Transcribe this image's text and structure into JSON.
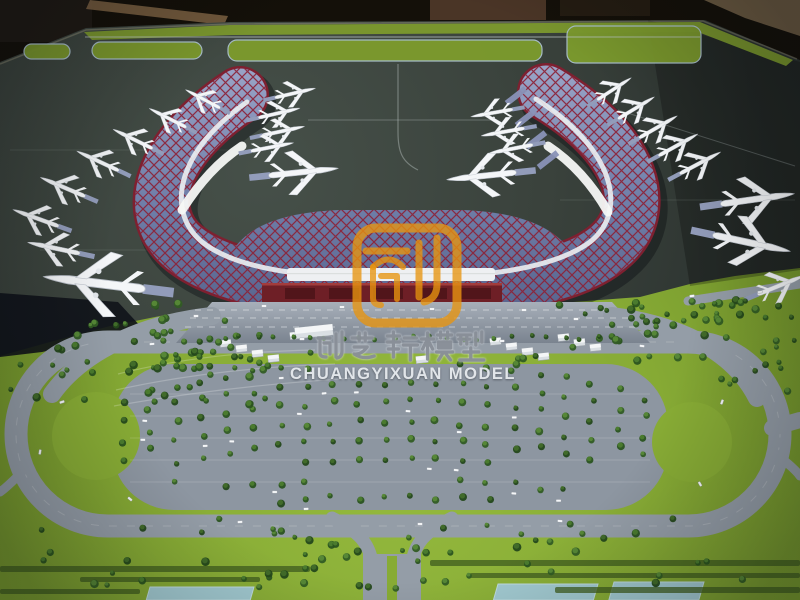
{
  "photo": {
    "subject": "Architectural scale model of an airport: U-shaped blue terminal with red lattice roof, white model aircraft at gates, tree-lined oval parking loop, displayed in a workshop",
    "watermark": {
      "logo_char": "创",
      "text_cn": "创艺轩模型",
      "text_en": "CHUANGYIXUAN MODEL",
      "logo_color": "#E8950F",
      "text_color": "#D8DCE2"
    }
  },
  "scene": {
    "colors": {
      "apron": "#3A423C",
      "grass": "#87AB35",
      "grassLight": "#95BA3E",
      "grassDark": "#74962C",
      "islandGreen": "#7C9A2D",
      "road": "#949DA7",
      "parking": "#8D96A1",
      "roofLight": "#98A3C6",
      "roofMid": "#7180AA",
      "roofDark": "#57628C",
      "lattice": "#8C2137",
      "rim": "#7E2030",
      "terminalFront": "#6E1F26",
      "canopy": "#EEF0F2",
      "water": "#A3CBD9",
      "workshop": "#141009",
      "plane": "#F4F6F8",
      "logoOrange": "#E8950F",
      "wmGray": "#8A9099"
    },
    "planes": [
      [
        203,
        99,
        -152,
        0.85
      ],
      [
        168,
        118,
        -153,
        0.9
      ],
      [
        133,
        139,
        -154,
        0.95
      ],
      [
        98,
        161,
        -155,
        1.0
      ],
      [
        63,
        187,
        -157,
        1.05
      ],
      [
        36,
        218,
        -160,
        1.05
      ],
      [
        54,
        248,
        -168,
        1.15
      ],
      [
        95,
        283,
        187,
        2.2
      ],
      [
        295,
        93,
        -13,
        0.9
      ],
      [
        279,
        113,
        -13,
        0.92
      ],
      [
        283,
        131,
        -12,
        0.94
      ],
      [
        272,
        147,
        -11,
        0.94
      ],
      [
        303,
        172,
        -6,
        1.5
      ],
      [
        492,
        113,
        170,
        0.92
      ],
      [
        503,
        132,
        170,
        0.95
      ],
      [
        511,
        149,
        169,
        0.97
      ],
      [
        482,
        176,
        174,
        1.5
      ],
      [
        614,
        89,
        -33,
        0.88
      ],
      [
        636,
        108,
        -31,
        0.92
      ],
      [
        658,
        127,
        -30,
        0.95
      ],
      [
        678,
        145,
        -29,
        0.97
      ],
      [
        700,
        163,
        -28,
        1.0
      ],
      [
        757,
        199,
        -8,
        1.6
      ],
      [
        751,
        243,
        12,
        1.7
      ],
      [
        781,
        285,
        -22,
        1.1
      ]
    ],
    "bridges_right": [
      [
        516,
        96
      ],
      [
        526,
        118
      ],
      [
        536,
        140
      ],
      [
        548,
        160
      ]
    ],
    "islands": [
      [
        24,
        44,
        46,
        15
      ],
      [
        92,
        42,
        110,
        17
      ],
      [
        228,
        40,
        314,
        21
      ],
      [
        567,
        26,
        134,
        37
      ]
    ],
    "sheds": [
      [
        220,
        340,
        11,
        7
      ],
      [
        236,
        345,
        11,
        7
      ],
      [
        252,
        350,
        11,
        7
      ],
      [
        268,
        355,
        11,
        7
      ],
      [
        290,
        332,
        12,
        7
      ],
      [
        295,
        326,
        38,
        11
      ],
      [
        416,
        356,
        12,
        7
      ],
      [
        490,
        338,
        11,
        7
      ],
      [
        506,
        343,
        11,
        7
      ],
      [
        522,
        348,
        11,
        7
      ],
      [
        538,
        353,
        11,
        7
      ],
      [
        558,
        334,
        11,
        7
      ],
      [
        574,
        339,
        11,
        7
      ],
      [
        590,
        344,
        11,
        7
      ]
    ],
    "pools": [
      [
        150,
        587,
        104,
        13
      ],
      [
        498,
        584,
        100,
        16
      ],
      [
        614,
        582,
        90,
        18
      ]
    ],
    "hedges": [
      [
        0,
        566,
        310,
        6
      ],
      [
        80,
        577,
        180,
        5
      ],
      [
        430,
        560,
        370,
        6
      ],
      [
        470,
        573,
        330,
        5
      ],
      [
        555,
        587,
        245,
        6
      ],
      [
        0,
        589,
        140,
        5
      ]
    ],
    "cars": [
      [
        62,
        402,
        -18
      ],
      [
        40,
        452,
        -80
      ],
      [
        152,
        344,
        -5
      ],
      [
        302,
        339,
        0
      ],
      [
        502,
        341,
        0
      ],
      [
        642,
        346,
        8
      ],
      [
        722,
        402,
        -70
      ],
      [
        700,
        484,
        60
      ],
      [
        560,
        521,
        5
      ],
      [
        420,
        524,
        0
      ],
      [
        240,
        522,
        -4
      ],
      [
        130,
        499,
        40
      ],
      [
        342,
        307,
        0
      ],
      [
        432,
        309,
        0
      ],
      [
        264,
        306,
        0
      ],
      [
        524,
        310,
        0
      ],
      [
        196,
        316,
        0
      ],
      [
        576,
        319,
        0
      ],
      [
        692,
        296,
        -8
      ],
      [
        760,
        292,
        -8
      ]
    ],
    "tree_clusters": [
      [
        60,
        323,
        200,
        55,
        26
      ],
      [
        140,
        368,
        130,
        40,
        12
      ],
      [
        8,
        345,
        85,
        55,
        9
      ],
      [
        556,
        296,
        188,
        70,
        26
      ],
      [
        688,
        296,
        108,
        26,
        14
      ],
      [
        716,
        330,
        80,
        62,
        12
      ],
      [
        30,
        516,
        340,
        72,
        26
      ],
      [
        400,
        518,
        372,
        70,
        26
      ],
      [
        248,
        548,
        200,
        42,
        10
      ],
      [
        150,
        300,
        75,
        45,
        12
      ],
      [
        606,
        303,
        64,
        42,
        10
      ],
      [
        120,
        352,
        430,
        16,
        18
      ]
    ],
    "plaza_tree_row": {
      "x0": 224,
      "x1": 606,
      "step": 17,
      "y": 338
    },
    "parking_grid": {
      "x0": 124,
      "cols": 21,
      "dx": 26,
      "xc": 390,
      "xr": 300,
      "cy": 436,
      "ry": 72,
      "dy": 19,
      "aisle_y": 472,
      "aisle_half": 8,
      "y_min": 366,
      "y_max": 506
    }
  }
}
